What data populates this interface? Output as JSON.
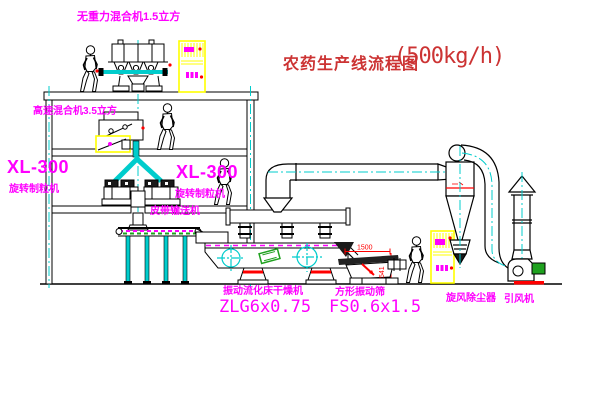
{
  "title": {
    "cn": "农药生产线流程图",
    "capacity": "(500kg/h)"
  },
  "labels": {
    "gravity_mixer": "无重力混合机1.5立方",
    "high_speed_mixer": "高速混合机3.5立方",
    "granulator_model_left": "XL-300",
    "granulator_name_left": "旋转制粒机",
    "granulator_model_mid": "XL-300",
    "granulator_name_mid": "旋转制粒机",
    "belt_conveyor": "皮带输送机",
    "dryer_name": "振动流化床干燥机",
    "dryer_model": "ZLG6x0.75",
    "screen_name": "方形振动筛",
    "screen_model": "FS0.6x1.5",
    "cyclone": "旋风除尘器",
    "fan": "引风机"
  },
  "dimensions": {
    "screen_width": "1500",
    "screen_height": "541"
  },
  "colors": {
    "background": "#FFFFFF",
    "line": "#000000",
    "pipe_cyan": "#00CCCC",
    "label_magenta": "#FF00FF",
    "title_red": "#CC3333",
    "cabinet_yellow": "#FFFF00",
    "accent_red": "#FF0000",
    "accent_green": "#1FA11F"
  }
}
